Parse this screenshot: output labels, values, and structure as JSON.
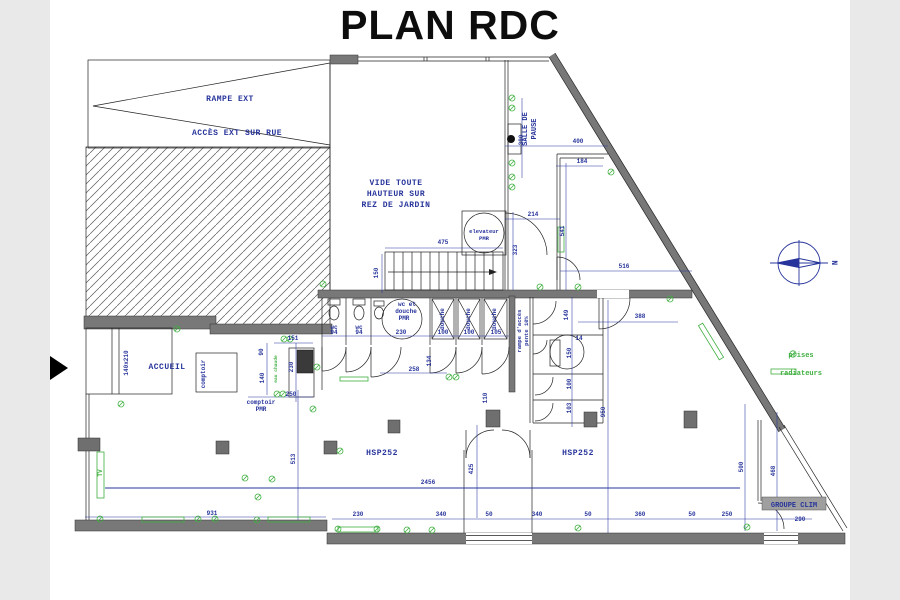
{
  "title": "PLAN RDC",
  "colors": {
    "annotation_blue": "#27349b",
    "symbol_green": "#3faf3f",
    "wall_gray": "#787878",
    "page_background": "#e9e9e9",
    "canvas_background": "#ffffff"
  },
  "plan": {
    "rooms": {
      "rampe_ext": "RAMPE EXT",
      "acces_ext": "ACCÈS EXT SUR RUE",
      "vide1": "VIDE TOUTE",
      "vide2": "HAUTEUR SUR",
      "vide3": "REZ DE JARDIN",
      "salle1": "SALLE DE",
      "salle2": "PAUSE",
      "elev1": "elevateur",
      "elev2": "PMR",
      "accueil": "ACCUEIL",
      "comptoir": "comptoir",
      "comptoir_pmr1": "comptoir",
      "comptoir_pmr2": "PMR",
      "wc_a": "wc",
      "wc_b": "wc",
      "pmr1": "wc et",
      "pmr2": "douche",
      "pmr3": "PMR",
      "douche1": "douche",
      "douche2": "douche",
      "douche3": "douche",
      "rampe1": "rampe d'accès",
      "rampe2": "pente 10%",
      "hsp_left": "HSP252",
      "hsp_right": "HSP252",
      "groupe_clim": "GROUPE CLIM",
      "window_size": "140x210",
      "tv": "TV",
      "eau_chaude": "eau chaude"
    },
    "legend": {
      "prises": "prises",
      "radiateurs": "radiateurs"
    },
    "compass_label": "N",
    "dimensions": [
      {
        "t": "475",
        "x": 443,
        "y": 244
      },
      {
        "t": "150",
        "x": 378,
        "y": 273,
        "v": 1
      },
      {
        "t": "323",
        "x": 517,
        "y": 250,
        "v": 1
      },
      {
        "t": "380",
        "x": 523,
        "y": 140,
        "v": 1
      },
      {
        "t": "400",
        "x": 578,
        "y": 143
      },
      {
        "t": "184",
        "x": 582,
        "y": 163
      },
      {
        "t": "214",
        "x": 533,
        "y": 216
      },
      {
        "t": "541",
        "x": 564,
        "y": 231,
        "v": 1
      },
      {
        "t": "516",
        "x": 624,
        "y": 268
      },
      {
        "t": "388",
        "x": 640,
        "y": 318
      },
      {
        "t": "151",
        "x": 293,
        "y": 340
      },
      {
        "t": "90",
        "x": 263,
        "y": 352,
        "v": 1
      },
      {
        "t": "140",
        "x": 264,
        "y": 378,
        "v": 1
      },
      {
        "t": "230",
        "x": 293,
        "y": 367,
        "v": 1
      },
      {
        "t": "250",
        "x": 291,
        "y": 396
      },
      {
        "t": "94",
        "x": 334,
        "y": 334
      },
      {
        "t": "94",
        "x": 359,
        "y": 334
      },
      {
        "t": "230",
        "x": 401,
        "y": 334
      },
      {
        "t": "100",
        "x": 443,
        "y": 334
      },
      {
        "t": "100",
        "x": 469,
        "y": 334
      },
      {
        "t": "105",
        "x": 496,
        "y": 334
      },
      {
        "t": "258",
        "x": 414,
        "y": 371
      },
      {
        "t": "134",
        "x": 431,
        "y": 361,
        "v": 1
      },
      {
        "t": "110",
        "x": 487,
        "y": 398,
        "v": 1
      },
      {
        "t": "149",
        "x": 568,
        "y": 315,
        "v": 1
      },
      {
        "t": "14",
        "x": 579,
        "y": 340
      },
      {
        "t": "150",
        "x": 571,
        "y": 353,
        "v": 1
      },
      {
        "t": "100",
        "x": 571,
        "y": 384,
        "v": 1
      },
      {
        "t": "103",
        "x": 571,
        "y": 408,
        "v": 1
      },
      {
        "t": "950",
        "x": 605,
        "y": 412,
        "v": 1
      },
      {
        "t": "2456",
        "x": 428,
        "y": 484
      },
      {
        "t": "513",
        "x": 295,
        "y": 459,
        "v": 1
      },
      {
        "t": "425",
        "x": 473,
        "y": 469,
        "v": 1
      },
      {
        "t": "500",
        "x": 743,
        "y": 467,
        "v": 1
      },
      {
        "t": "468",
        "x": 775,
        "y": 471,
        "v": 1
      },
      {
        "t": "931",
        "x": 212,
        "y": 515
      },
      {
        "t": "230",
        "x": 358,
        "y": 516
      },
      {
        "t": "340",
        "x": 441,
        "y": 516
      },
      {
        "t": "50",
        "x": 489,
        "y": 516
      },
      {
        "t": "340",
        "x": 537,
        "y": 516
      },
      {
        "t": "50",
        "x": 588,
        "y": 516
      },
      {
        "t": "360",
        "x": 640,
        "y": 516
      },
      {
        "t": "50",
        "x": 692,
        "y": 516
      },
      {
        "t": "250",
        "x": 727,
        "y": 516
      },
      {
        "t": "290",
        "x": 800,
        "y": 521
      }
    ],
    "prises": [
      [
        512,
        98
      ],
      [
        512,
        108
      ],
      [
        512,
        163
      ],
      [
        512,
        177
      ],
      [
        512,
        187
      ],
      [
        611,
        172
      ],
      [
        177,
        329
      ],
      [
        284,
        339
      ],
      [
        290,
        339
      ],
      [
        323,
        284
      ],
      [
        317,
        367
      ],
      [
        277,
        394
      ],
      [
        283,
        394
      ],
      [
        313,
        409
      ],
      [
        121,
        404
      ],
      [
        449,
        377
      ],
      [
        456,
        377
      ],
      [
        540,
        287
      ],
      [
        578,
        287
      ],
      [
        670,
        299
      ],
      [
        100,
        519
      ],
      [
        198,
        519
      ],
      [
        215,
        519
      ],
      [
        257,
        520
      ],
      [
        245,
        478
      ],
      [
        272,
        479
      ],
      [
        258,
        497
      ],
      [
        340,
        451
      ],
      [
        338,
        529
      ],
      [
        377,
        529
      ],
      [
        407,
        530
      ],
      [
        432,
        530
      ],
      [
        578,
        528
      ],
      [
        747,
        527
      ]
    ],
    "radiators": [
      [
        142,
        517,
        42,
        5
      ],
      [
        268,
        517,
        42,
        5
      ],
      [
        338,
        527,
        40,
        5
      ],
      [
        340,
        377,
        28,
        4
      ],
      [
        97,
        452,
        7,
        46
      ],
      [
        558,
        227,
        6,
        25
      ],
      [
        691,
        339,
        40,
        5,
        58.5
      ]
    ],
    "pillars": [
      [
        216,
        441,
        13,
        13
      ],
      [
        324,
        441,
        13,
        13
      ],
      [
        388,
        420,
        12,
        13
      ],
      [
        486,
        410,
        14,
        17
      ],
      [
        584,
        412,
        13,
        15
      ],
      [
        684,
        411,
        13,
        17
      ],
      [
        78,
        438,
        22,
        13
      ]
    ]
  }
}
